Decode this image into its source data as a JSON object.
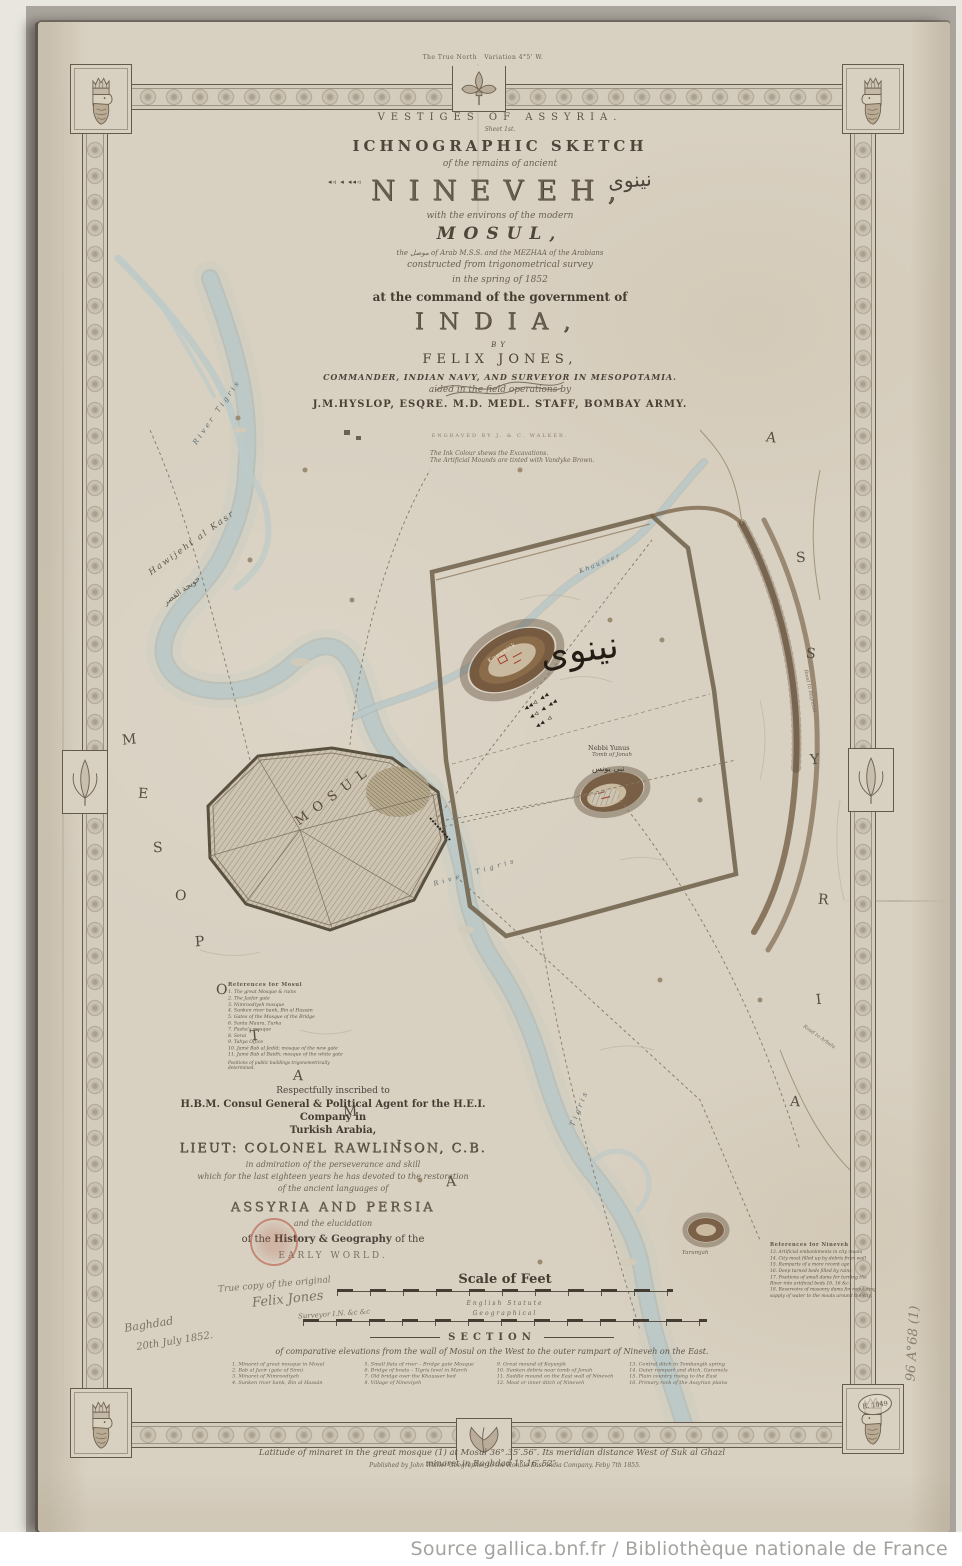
{
  "source_bar": "Source gallica.bnf.fr / Bibliothèque nationale de France",
  "compass": {
    "note": "The True North",
    "variation": "Variation 4°5' W."
  },
  "title_block": {
    "vestiges": "VESTIGES OF ASSYRIA.",
    "sheet": "Sheet 1st.",
    "ichnographic": "ICHNOGRAPHIC SKETCH",
    "remains": "of the remains of ancient",
    "nineveh": "NINEVEH,",
    "nineveh_arabic": "نينوى",
    "cuneiform_mark": "◂◃ ◂ ◂◂◃",
    "environs": "with the environs of the modern",
    "mosul": "MOSUL,",
    "arab_line": "the موصل of Arab M.S.S. and the MEZHAA of the Arabians",
    "constructed": "constructed from trigonometrical survey",
    "spring": "in the spring of 1852",
    "command": "at the command of the government of",
    "india": "INDIA,",
    "by": "BY",
    "felix": "FELIX JONES,",
    "commander": "COMMANDER, INDIAN NAVY, AND SURVEYOR IN MESOPOTAMIA.",
    "aided": "aided in the field operations by",
    "hyslop": "J.M.HYSLOP, ESQRE. M.D. MEDL. STAFF, BOMBAY ARMY.",
    "engraved": "ENGRAVED BY J. & C. WALKER.",
    "note1": "The Ink Colour shews the Excavations.",
    "note2": "The Artificial Mounds are tinted with Vandyke Brown."
  },
  "map_labels": {
    "river_tigris_upper": "River Tigris",
    "hawijeht": "Hawijeht al Kasr",
    "hawijeht_arabic": "حويجة القصر",
    "mosul_city": "MOSUL",
    "koyunjik": "Koyunjik",
    "khausser": "Khausser",
    "nineveh_arabic_large": "نينوى",
    "cuneiform_line1": "◂◂◃ ◂◂",
    "cuneiform_line2": "◂◃ ◂ ◂◂",
    "cuneiform_line3": "◂◂ ◃",
    "nebbi_yunus": "Nebbi Yunus",
    "tomb_of_jonah": "Tomb of Jonah",
    "nebbi_yunus_arabic": "نبي يونس",
    "river_tigris_mid": "River Tigris",
    "tigris_lower": "Tigris",
    "yarumjah": "Yarumjah",
    "road_baghdad": "Road to Baghdad",
    "road_arbela": "Road to Arbela"
  },
  "region_letters": {
    "mesopotamia": [
      "M",
      "E",
      "S",
      "O",
      "P",
      "O",
      "T",
      "A",
      "M",
      "I",
      "A"
    ],
    "assyria": [
      "A",
      "S",
      "S",
      "Y",
      "R",
      "I",
      "A"
    ]
  },
  "mosul_references": {
    "title": "References for Mosul",
    "items": [
      "1. The great Mosque & ruins",
      "2. The Jazfar gate",
      "3. Nimroodíyeh mosque",
      "4. Sunken river bank, Bin al Hassán",
      "5. Gates of the Mosque of the Bridge",
      "6. Santa Maura, Turka",
      "7. Pasha's mosque",
      "8. Serai",
      "9. Tahya Office",
      "10. Jamé Bab al Jedíd; mosque of the new gate",
      "11. Jamé Bab al Baidh; mosque of the white gate"
    ],
    "footnote": "Positions of public buildings trigonometrically determined."
  },
  "nineveh_references": {
    "title": "References for Nineveh",
    "items": [
      "13. Artificial embankments in city moats",
      "14. City moat filled up by debris from wall",
      "15. Ramparts of a more recent age",
      "16. Deep turned beds filled by rains",
      "17. Positions of small dams for turning the River into artificial beds 16, 16 &c.",
      "18. Reservoirs of masonry dams for regulating supply of water to the moats around the city."
    ]
  },
  "dedication": {
    "line1": "Respectfully inscribed to",
    "line2": "H.B.M. Consul General & Political Agent for the H.E.I. Company in",
    "line3": "Turkish Arabia,",
    "line4": "LIEUT: COLONEL RAWLINSON, C.B.",
    "line5": "in admiration of the perseverance and skill",
    "line6": "which for the last eighteen years he has devoted to the restoration",
    "line7": "of the ancient languages of",
    "line8": "ASSYRIA AND PERSIA",
    "line9": "and the elucidation",
    "line10_pre": "of the ",
    "line10_bold": "History & Geography ",
    "line10_post": "of the",
    "line11": "EARLY WORLD."
  },
  "manuscript": {
    "line1": "True copy of the original",
    "signature": "Felix Jones",
    "line2": "Surveyor I.N. &c &c",
    "place": "Baghdad",
    "date": "20th July 1852."
  },
  "stamps": {
    "oval": "R. 1849",
    "shelfmark": "96 A°68 (1)"
  },
  "scale": {
    "title": "Scale of Feet",
    "label1": "English Statute",
    "label2": "Geographical"
  },
  "section": {
    "heading": "SECTION",
    "description": "of comparative elevations from the wall of Mosul on the West to the outer rampart of Nineveh on the East.",
    "items": [
      {
        "n": "1.",
        "t": "Minaret of great mosque in Mosul"
      },
      {
        "n": "2.",
        "t": "Bab al Jazír (gate of Sinn)"
      },
      {
        "n": "3.",
        "t": "Minaret of Nimroodíyeh"
      },
      {
        "n": "4.",
        "t": "Sunken river bank, Bin al Hassán"
      },
      {
        "n": "5.",
        "t": "Small flats of river – Bridge gate Mosque"
      },
      {
        "n": "6.",
        "t": "Bridge of boats – Tigris level in March"
      },
      {
        "n": "7.",
        "t": "Old bridge over the Khausser bed"
      },
      {
        "n": "8.",
        "t": "Village of Ninevíyeh"
      },
      {
        "n": "9.",
        "t": "Great mound of Koyunjik"
      },
      {
        "n": "10.",
        "t": "Sunken debris near tomb of Jonah"
      },
      {
        "n": "11.",
        "t": "Saddle mound on the East wall of Nineveh"
      },
      {
        "n": "12.",
        "t": "Moat or inner ditch of Nineveh"
      },
      {
        "n": "13.",
        "t": "Central ditch in Tombangik spring"
      },
      {
        "n": "14.",
        "t": "Outer rampart and ditch, Garamels"
      },
      {
        "n": "15.",
        "t": "Plain country rising to the East"
      },
      {
        "n": "16.",
        "t": "Primary rock of the Assyrian plains"
      }
    ],
    "lat1": "Latitude of minaret in the great mosque (1) at Mosul 36°.35′.56″.  Its meridian distance West of Suk al Ghazl",
    "lat2": "minaret in Baghdad 1°.16′.52″."
  },
  "imprint": "Published by John Walker Geographer to the Honble East India Company. Feby 7th 1855.",
  "colors": {
    "paper": "#d8d0c1",
    "river": "#b9c6c6",
    "mound_brown": "#6b4e33",
    "excavation_red": "#a33b2a",
    "stamp_red": "#b5584a"
  }
}
